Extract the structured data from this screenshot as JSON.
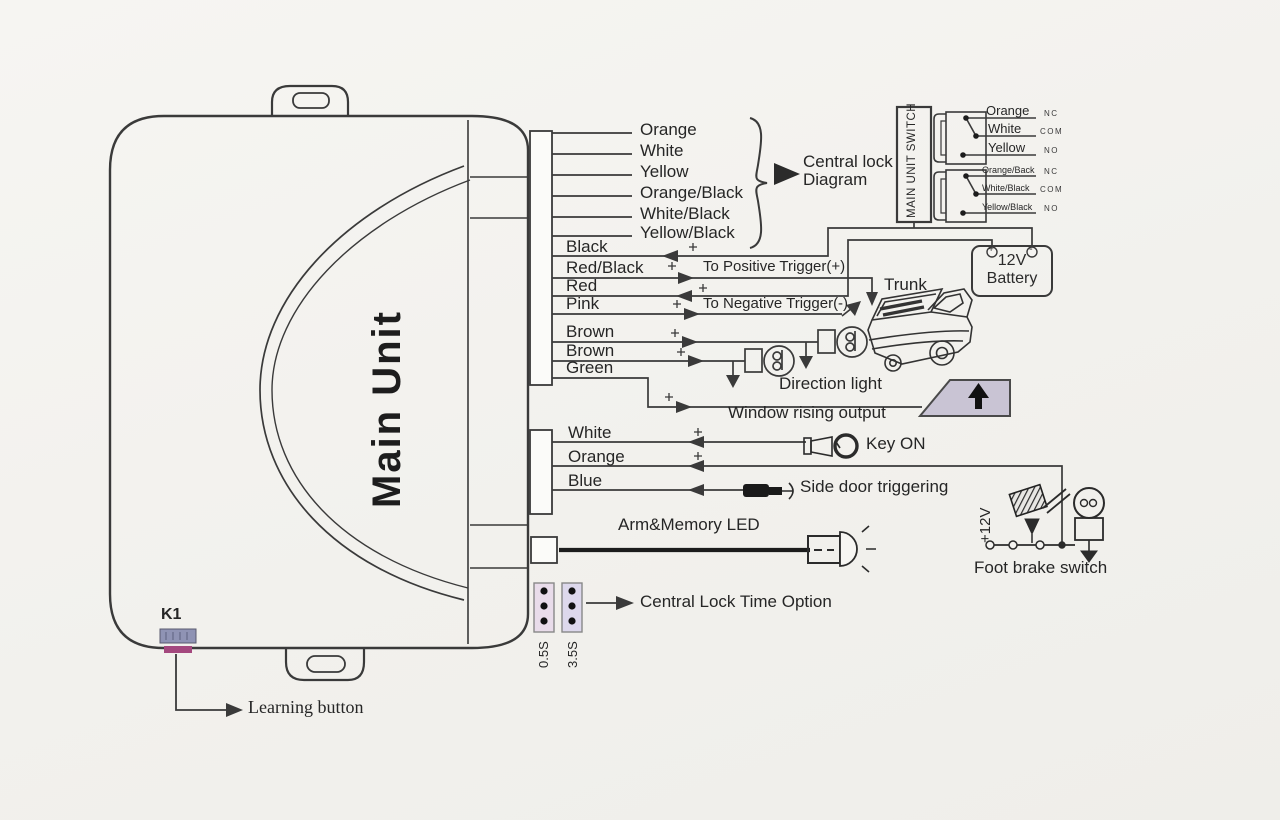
{
  "colors": {
    "ink": "#3a3a3a",
    "paper": "#f4f3f0",
    "window_glyph_fill": "#c9c4d4",
    "jumper_fill_left": "#e9dcea",
    "jumper_fill_right": "#ddd8ec",
    "k1_button_top": "#8f93b4",
    "k1_button_bottom": "#a4487e"
  },
  "main_unit": {
    "title": "Main Unit",
    "k1": "K1",
    "learning_button": "Learning button"
  },
  "top_wires": [
    "Orange",
    "White",
    "Yellow",
    "Orange/Black",
    "White/Black",
    "Yellow/Black"
  ],
  "central_lock": {
    "line1": "Central lock",
    "line2": "Diagram"
  },
  "switch_panel": {
    "title": "MAIN UNIT SWITCH",
    "rows": [
      {
        "wire": "Orange",
        "contact": "NC"
      },
      {
        "wire": "White",
        "contact": "COM"
      },
      {
        "wire": "Yellow",
        "contact": "NO"
      },
      {
        "wire": "Orange/Back",
        "contact": "NC"
      },
      {
        "wire": "White/Black",
        "contact": "COM"
      },
      {
        "wire": "Yellow/Black",
        "contact": "NO"
      }
    ]
  },
  "mid_wires": [
    "Black",
    "Red/Black",
    "Red",
    "Pink",
    "Brown",
    "Brown",
    "Green"
  ],
  "triggers": {
    "positive": "To Positive Trigger(+)",
    "negative": "To Negative Trigger(-)"
  },
  "battery": {
    "volts": "12V",
    "name": "Battery",
    "plus": "+",
    "minus": "-"
  },
  "lower_wires": [
    "White",
    "Orange",
    "Blue"
  ],
  "jumpers": [
    "0.5S",
    "3.5S"
  ],
  "labels": {
    "trunk": "Trunk",
    "direction_light": "Direction light",
    "window_rising": "Window rising output",
    "key_on": "Key ON",
    "side_door": "Side door triggering",
    "arm_led": "Arm&Memory LED",
    "plus12v": "+12V",
    "foot_brake": "Foot brake switch",
    "central_lock_time": "Central Lock Time Option"
  }
}
